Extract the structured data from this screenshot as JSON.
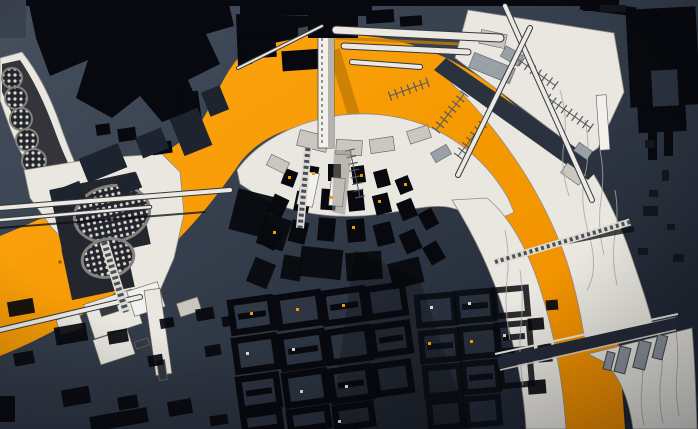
{
  "meta": {
    "title": "Aerial architectural model photograph: city masterplan with orange river bend",
    "canvas": {
      "w": 698,
      "h": 429
    }
  },
  "palette": {
    "bg_top": "#46505f",
    "bg_mid": "#343d4b",
    "bg_low": "#232a36",
    "bg_deep": "#1c2330",
    "black": "#07090e",
    "navy_block": "#1d2430",
    "channel": "#2a3240",
    "river_hi": "#ffa716",
    "river_lo": "#ee8d00",
    "river_shadow": "#c47c05",
    "white": "#e9e7e0",
    "white_hi": "#f2f0ea",
    "white_shade": "#c9c7c0",
    "gray": "#9aa0a8",
    "line_dark": "#34383f",
    "contour": "#a8a6a0",
    "dome_bg": "#23262c",
    "dome_dot": "#d8d6cf",
    "dot_orange": "#f59b00",
    "dot_pale": "#d9d7cf"
  },
  "scene": {
    "river_path": "M0 236 C70 207 138 176 193 132 C212 112 220 76 242 54 C282 35 332 30 382 38 C432 46 476 70 510 101 C544 132 570 172 588 216 C606 262 616 310 620 360 L625 429 L534 429 C532 368 526 310 511 264 C496 218 472 180 440 154 C407 128 362 118 319 123 C281 127 253 143 237 167 C220 192 194 226 158 259 C119 294 60 332 0 356 Z",
    "peninsula_path": "M237 170 C254 146 284 128 320 119 C360 109 402 114 436 130 C468 146 492 170 508 198 L514 212 C500 222 478 216 452 208 C430 202 400 214 360 216 C320 218 285 210 262 198 L240 184 Z",
    "west_bank_path": "M452 200 C472 232 492 272 505 315 C516 352 524 392 526 429 L566 429 C563 382 554 332 540 288 C527 247 508 215 487 198 Z",
    "east_bank_path": "M452 64 L500 96 L548 132 L586 162 C602 186 620 222 632 258 C640 282 648 304 652 322 L676 317 L648 332 L585 341 C580 310 572 272 560 243 C546 208 528 176 506 146 C490 124 472 102 452 84 Z",
    "lower_bank_path": "M588 354 L676 332 L692 328 C695 362 696 396 697 429 L633 429 C629 400 620 376 604 362 Z",
    "triangle_path": "M468 10 L614 33 L624 92 L598 148 L586 156 L455 58 Z",
    "channel_path": "M446 58 L602 166 L588 180 L434 70 Z",
    "left_band_path": "M0 58 L22 52 C38 72 52 100 62 130 C70 152 78 172 88 186 L60 208 C40 188 22 160 10 128 L0 100 Z",
    "band_dark_path": "M2 64 L20 60 C34 80 46 106 56 134 C62 150 68 164 76 178 L56 192 C40 174 24 146 14 118 L2 92 Z",
    "plaza_path": "M24 170 L98 158 L162 154 L180 172 L184 214 L174 258 L158 295 L128 304 L52 228 L30 198 Z",
    "plaza_squares": [
      [
        56,
        180,
        88,
        74,
        -12
      ],
      [
        66,
        242,
        64,
        52,
        -12
      ]
    ],
    "big_domes": [
      [
        112,
        214,
        38,
        28,
        -12
      ],
      [
        108,
        258,
        26,
        19,
        -12
      ]
    ],
    "small_domes": [
      [
        12,
        78,
        10
      ],
      [
        16,
        98,
        11
      ],
      [
        21,
        119,
        11
      ],
      [
        27,
        140,
        11
      ],
      [
        34,
        161,
        12
      ],
      [
        42,
        181,
        12
      ]
    ],
    "topleft_mass_path": "M28 0 L228 0 L234 26 L206 34 L220 64 L188 80 L200 108 L162 122 L140 96 L112 118 L76 98 L88 60 L50 76 L36 38 Z",
    "steps_path": "M236 14 L322 16 L322 24 L298 28 L298 38 L274 43 L274 52 L252 57 L252 64 L238 66 Z",
    "gap_path": "M497 357 L678 317 L678 329 L499 369 Z",
    "fan_shadow_path": "M355 250 L420 280 L470 429 L330 429 Z",
    "top_strip": [
      [
        15,
        0,
        570,
        6,
        0
      ],
      [
        108,
        0,
        70,
        11,
        0
      ],
      [
        240,
        0,
        118,
        15,
        0
      ],
      [
        583,
        0,
        36,
        11,
        0
      ]
    ],
    "tl_satellites": [
      [
        240,
        34,
        36,
        24,
        -4
      ],
      [
        282,
        50,
        40,
        20,
        -4
      ],
      [
        118,
        128,
        18,
        13,
        -8
      ],
      [
        152,
        142,
        20,
        12,
        -8
      ],
      [
        96,
        124,
        14,
        11,
        -8
      ],
      [
        178,
        92,
        22,
        30,
        -8
      ],
      [
        366,
        10,
        28,
        13,
        -4
      ],
      [
        400,
        16,
        22,
        10,
        -4
      ],
      [
        0,
        0,
        26,
        38,
        0
      ]
    ],
    "navy_blocks": [
      [
        82,
        150,
        42,
        26,
        -22
      ],
      [
        138,
        132,
        28,
        22,
        -22
      ],
      [
        176,
        112,
        30,
        40,
        -22
      ],
      [
        118,
        176,
        22,
        16,
        -22
      ],
      [
        52,
        186,
        32,
        20,
        -22
      ],
      [
        205,
        88,
        20,
        26,
        -22
      ]
    ],
    "east_building": [
      [
        628,
        8,
        70,
        98,
        -3
      ],
      [
        638,
        104,
        48,
        28,
        -3
      ],
      [
        648,
        132,
        9,
        28,
        0
      ],
      [
        664,
        128,
        9,
        28,
        0
      ],
      [
        580,
        4,
        56,
        9,
        7
      ]
    ],
    "east_building_notch": [
      652,
      70,
      26,
      36,
      -3
    ],
    "east_marks": [
      [
        645,
        140,
        10,
        8,
        0
      ],
      [
        662,
        170,
        7,
        11,
        0
      ],
      [
        649,
        190,
        9,
        7,
        0
      ],
      [
        643,
        206,
        15,
        10,
        0
      ],
      [
        667,
        224,
        8,
        6,
        0
      ],
      [
        638,
        248,
        10,
        7,
        0
      ],
      [
        673,
        254,
        11,
        8,
        0
      ],
      [
        600,
        5,
        26,
        7,
        0
      ]
    ],
    "fan_blocks": [
      [
        283,
        170,
        13,
        16,
        20
      ],
      [
        305,
        166,
        13,
        17,
        10
      ],
      [
        328,
        164,
        13,
        17,
        0
      ],
      [
        352,
        166,
        13,
        17,
        -8
      ],
      [
        375,
        170,
        14,
        17,
        -15
      ],
      [
        397,
        177,
        14,
        16,
        -22
      ],
      [
        270,
        196,
        16,
        20,
        25
      ],
      [
        295,
        192,
        15,
        20,
        12
      ],
      [
        321,
        189,
        15,
        21,
        4
      ],
      [
        348,
        190,
        16,
        21,
        -6
      ],
      [
        374,
        194,
        16,
        20,
        -14
      ],
      [
        399,
        200,
        16,
        19,
        -22
      ],
      [
        421,
        210,
        15,
        18,
        -28
      ],
      [
        262,
        226,
        18,
        22,
        28
      ],
      [
        290,
        221,
        17,
        22,
        14
      ],
      [
        318,
        218,
        17,
        23,
        5
      ],
      [
        347,
        219,
        18,
        23,
        -5
      ],
      [
        375,
        223,
        18,
        22,
        -14
      ],
      [
        402,
        231,
        17,
        21,
        -24
      ],
      [
        426,
        243,
        16,
        20,
        -30
      ]
    ],
    "fan_blobs": [
      [
        233,
        192,
        36,
        42,
        14
      ],
      [
        260,
        216,
        28,
        32,
        18
      ],
      [
        300,
        248,
        42,
        30,
        6
      ],
      [
        346,
        252,
        36,
        28,
        -4
      ],
      [
        390,
        260,
        32,
        26,
        -14
      ],
      [
        250,
        260,
        22,
        26,
        22
      ],
      [
        282,
        256,
        20,
        24,
        10
      ]
    ],
    "hollow_a": [
      [
        232,
        300,
        40,
        30,
        1
      ],
      [
        278,
        295,
        42,
        30,
        0
      ],
      [
        324,
        291,
        40,
        30,
        1
      ],
      [
        368,
        287,
        36,
        28,
        0
      ],
      [
        236,
        338,
        40,
        31,
        0
      ],
      [
        282,
        334,
        42,
        32,
        1
      ],
      [
        329,
        330,
        40,
        30,
        0
      ],
      [
        373,
        325,
        36,
        28,
        1
      ],
      [
        240,
        377,
        38,
        30,
        1
      ],
      [
        286,
        373,
        40,
        30,
        0
      ],
      [
        332,
        369,
        38,
        30,
        1
      ],
      [
        376,
        364,
        34,
        28,
        0
      ],
      [
        244,
        413,
        36,
        16,
        0
      ],
      [
        290,
        410,
        38,
        18,
        0
      ],
      [
        336,
        406,
        36,
        20,
        0
      ]
    ],
    "hollow_b": [
      [
        418,
        296,
        36,
        28,
        0
      ],
      [
        457,
        292,
        36,
        28,
        1
      ],
      [
        495,
        289,
        32,
        26,
        0
      ],
      [
        422,
        332,
        36,
        28,
        1
      ],
      [
        461,
        328,
        36,
        28,
        0
      ],
      [
        498,
        324,
        32,
        26,
        1
      ],
      [
        426,
        367,
        34,
        28,
        0
      ],
      [
        464,
        363,
        34,
        28,
        1
      ],
      [
        501,
        359,
        30,
        26,
        0
      ],
      [
        430,
        401,
        32,
        26,
        0
      ],
      [
        467,
        398,
        32,
        26,
        0
      ]
    ],
    "scatter_blocks": [
      [
        8,
        300,
        26,
        15,
        -10
      ],
      [
        55,
        325,
        32,
        18,
        -10
      ],
      [
        14,
        352,
        20,
        13,
        -10
      ],
      [
        108,
        330,
        20,
        13,
        -10
      ],
      [
        148,
        355,
        15,
        11,
        -10
      ],
      [
        62,
        388,
        28,
        17,
        -10
      ],
      [
        118,
        396,
        20,
        13,
        -10
      ],
      [
        168,
        400,
        24,
        15,
        -10
      ],
      [
        210,
        415,
        18,
        10,
        -10
      ],
      [
        90,
        412,
        58,
        15,
        -10
      ],
      [
        0,
        396,
        15,
        26,
        0
      ],
      [
        160,
        318,
        14,
        10,
        -10
      ],
      [
        196,
        308,
        18,
        12,
        -10
      ],
      [
        222,
        316,
        14,
        10,
        -10
      ],
      [
        205,
        345,
        16,
        11,
        -10
      ],
      [
        528,
        318,
        16,
        12,
        -5
      ],
      [
        538,
        344,
        14,
        18,
        -5
      ],
      [
        528,
        380,
        18,
        14,
        -5
      ],
      [
        546,
        300,
        12,
        10,
        -5
      ]
    ],
    "bl_rects": [
      [
        88,
        296,
        50,
        36,
        -18,
        "#e9e7e0"
      ],
      [
        130,
        286,
        32,
        26,
        -18,
        "#f2f0ea"
      ],
      [
        96,
        334,
        36,
        26,
        -18,
        "#e9e7e0"
      ],
      [
        150,
        289,
        16,
        86,
        -8,
        "#e9e7e0"
      ],
      [
        58,
        316,
        24,
        16,
        -18,
        "#e9e7e0"
      ],
      [
        178,
        300,
        22,
        14,
        -18,
        "#c9c7c0"
      ],
      [
        100,
        306,
        18,
        8,
        -18,
        "#34383f"
      ],
      [
        135,
        340,
        14,
        7,
        -18,
        "#34383f"
      ],
      [
        158,
        360,
        8,
        20,
        -8,
        "#34383f"
      ]
    ],
    "detail_quads": [
      [
        298,
        133,
        30,
        16,
        14,
        "#c9c7c0"
      ],
      [
        336,
        140,
        26,
        15,
        3,
        "#c9c7c0"
      ],
      [
        370,
        138,
        24,
        14,
        -8,
        "#c9c7c0"
      ],
      [
        268,
        158,
        20,
        12,
        26,
        "#c9c7c0"
      ],
      [
        408,
        128,
        22,
        13,
        -18,
        "#c9c7c0"
      ],
      [
        300,
        172,
        16,
        34,
        12,
        "#f2f0ea"
      ],
      [
        330,
        178,
        14,
        28,
        6,
        "#f2f0ea"
      ],
      [
        432,
        148,
        18,
        11,
        -30,
        "#9aa0a8"
      ],
      [
        470,
        60,
        44,
        16,
        22,
        "#9aa0a8"
      ],
      [
        480,
        32,
        26,
        14,
        12,
        "#c9c7c0"
      ],
      [
        502,
        50,
        20,
        12,
        30,
        "#9aa0a8"
      ],
      [
        575,
        146,
        16,
        10,
        35,
        "#9aa0a8"
      ],
      [
        562,
        168,
        22,
        12,
        35,
        "#c9c7c0"
      ],
      [
        598,
        95,
        10,
        55,
        -4,
        "#f2f0ea"
      ]
    ],
    "ladders": [
      [
        516,
        58,
        48,
        35,
        7
      ],
      [
        548,
        98,
        52,
        35,
        8
      ],
      [
        436,
        130,
        46,
        -52,
        7
      ],
      [
        458,
        156,
        40,
        -52,
        6
      ],
      [
        350,
        150,
        48,
        78,
        7
      ],
      [
        390,
        96,
        40,
        -20,
        6
      ]
    ],
    "bridges": [
      [
        505,
        6,
        592,
        200,
        4
      ],
      [
        530,
        28,
        458,
        175,
        4
      ],
      [
        0,
        208,
        230,
        190,
        4
      ],
      [
        0,
        220,
        150,
        207,
        2.5
      ],
      [
        0,
        330,
        140,
        297,
        4
      ],
      [
        336,
        30,
        500,
        38,
        7
      ],
      [
        344,
        46,
        468,
        52,
        5
      ],
      [
        352,
        62,
        420,
        67,
        4
      ],
      [
        238,
        68,
        322,
        26,
        2
      ]
    ],
    "dark_lines": [
      [
        0,
        228,
        205,
        212,
        2
      ],
      [
        560,
        243,
        634,
        229,
        5
      ]
    ],
    "lattice": [
      [
        104,
        242,
        126,
        312,
        9
      ],
      [
        495,
        262,
        630,
        222,
        7
      ],
      [
        308,
        148,
        300,
        228,
        8
      ]
    ],
    "river_shadows": [
      [
        334,
        50,
        362,
        142,
        12
      ],
      [
        336,
        38,
        500,
        46,
        3
      ]
    ],
    "pontoons": [
      [
        605,
        352,
        8,
        18,
        14
      ],
      [
        617,
        347,
        11,
        26,
        14
      ],
      [
        636,
        341,
        12,
        28,
        14
      ],
      [
        655,
        335,
        10,
        24,
        14
      ]
    ],
    "contours": [
      "M585 120 q6 30 0 55 t4 60 t-2 55",
      "M600 150 q5 25 1 50 t3 55",
      "M615 190 q4 22 0 45 t2 50",
      "M505 230 q5 25 2 50 t3 60",
      "M520 270 q4 28 1 55 t2 60",
      "M640 340 q4 22 2 45 t2 40",
      "M660 336 q4 20 1 42 t2 45",
      "M676 332 q3 20 1 40 t2 44",
      "M560 90 q8 26 4 52 t5 54"
    ],
    "column": {
      "cap": [
        308,
        0,
        50,
        38
      ],
      "cap2": [
        352,
        2,
        20,
        14
      ],
      "shaft": [
        318,
        10,
        16,
        138
      ],
      "shade": [
        328,
        10,
        6,
        138
      ]
    },
    "dots_orange": [
      [
        288,
        176
      ],
      [
        312,
        172
      ],
      [
        360,
        174
      ],
      [
        404,
        183
      ],
      [
        330,
        196
      ],
      [
        378,
        200
      ],
      [
        273,
        231
      ],
      [
        352,
        226
      ],
      [
        250,
        312
      ],
      [
        296,
        308
      ],
      [
        342,
        304
      ],
      [
        428,
        342
      ],
      [
        470,
        340
      ]
    ],
    "dots_pale": [
      [
        246,
        352
      ],
      [
        292,
        348
      ],
      [
        300,
        390
      ],
      [
        345,
        385
      ],
      [
        430,
        306
      ],
      [
        468,
        302
      ],
      [
        503,
        334
      ],
      [
        338,
        420
      ]
    ],
    "dots_dark": [
      [
        64,
        250
      ],
      [
        74,
        258
      ],
      [
        86,
        252
      ],
      [
        92,
        264
      ],
      [
        70,
        268
      ],
      [
        82,
        270
      ],
      [
        96,
        256
      ],
      [
        60,
        262
      ]
    ]
  }
}
